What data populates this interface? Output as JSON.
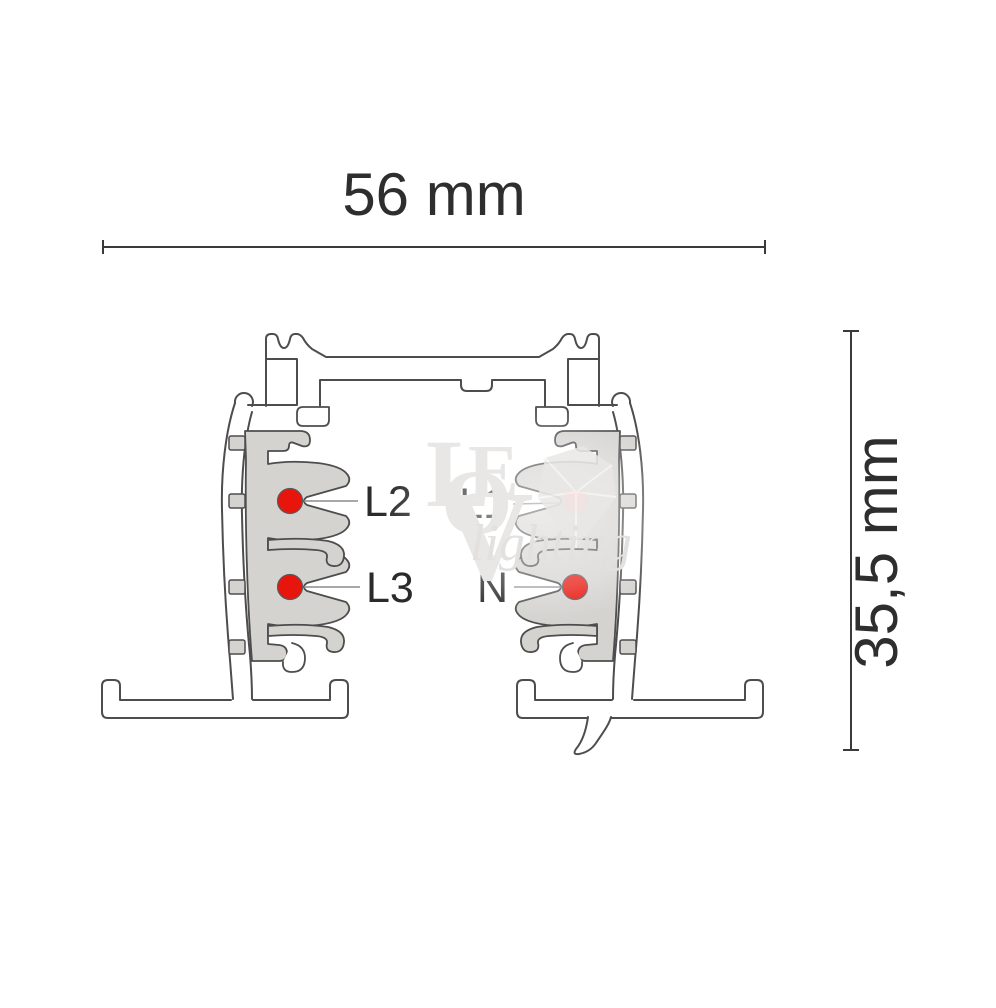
{
  "diagram": {
    "type": "lighting-track-cross-section",
    "dimensions": {
      "width_label": "56 mm",
      "height_label": "35,5 mm"
    },
    "conductors": [
      {
        "label": "L2",
        "side": "left",
        "row": "upper"
      },
      {
        "label": "L3",
        "side": "left",
        "row": "lower"
      },
      {
        "label": "L1",
        "side": "right",
        "row": "upper"
      },
      {
        "label": "N",
        "side": "right",
        "row": "lower"
      }
    ],
    "colors": {
      "conductor_red": "#e8150d",
      "insulator_gray": "#d5d3d0",
      "outline_gray": "#4d4d4d",
      "leader_gray": "#8c8c8c",
      "dimension_gray": "#3a3a3a"
    },
    "watermark": {
      "letters": [
        "L",
        "O",
        "E",
        "V"
      ],
      "script": "lighting"
    }
  }
}
